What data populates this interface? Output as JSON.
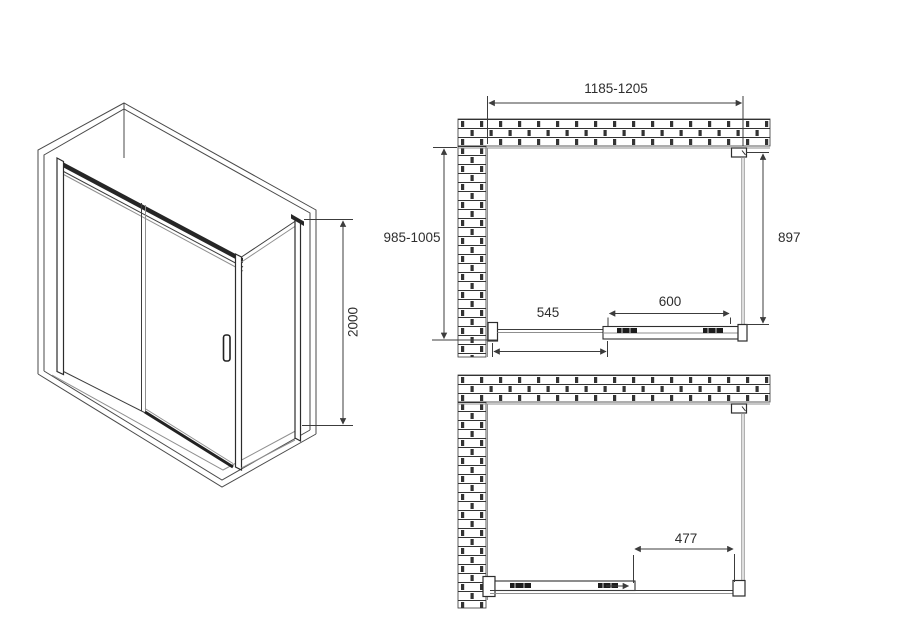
{
  "drawing": {
    "perspective": {
      "dim_height": "2000"
    },
    "plan_closed": {
      "dim_overall_width": "1185-1205",
      "dim_overall_depth": "985-1005",
      "dim_side_panel": "897",
      "dim_fixed_segment": "545",
      "dim_door_panel": "600"
    },
    "plan_open": {
      "dim_opening": "477"
    }
  },
  "colors": {
    "background": "#ffffff",
    "line": "#3c3c3c",
    "dark_profile": "#262626",
    "glass_gray": "#8f8f8f"
  }
}
